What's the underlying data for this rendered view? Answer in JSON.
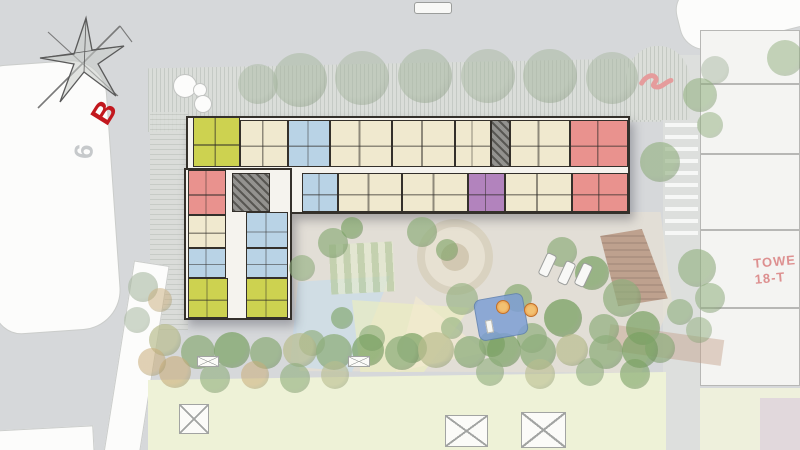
{
  "page": {
    "background": "#d6d8da"
  },
  "labels": {
    "block_marker": "B",
    "road_number": "9",
    "tower_line1": "TOWE",
    "tower_line2": "18-T"
  },
  "palette": {
    "wall": "#34302b",
    "cream": "#f0e9cf",
    "lime": "#cdd250",
    "blue": "#b9d3e6",
    "red": "#e9928e",
    "purple": "#b283bd",
    "core": "#93928f",
    "corridor": "#f5f3ee",
    "lawn": "#eef2d7",
    "pool": "#7e9fd4",
    "umbrella_orange": "#e8923e",
    "marker_red": "#c2181e",
    "tower_text": "#dd9090",
    "tree_faded": "#a9b9a2",
    "tree_mid": "#8fae7c",
    "tree_bright": "#79a162",
    "tree_olive": "#b9bd8e",
    "tree_orange": "#c9ad79"
  },
  "building": {
    "slabs": [
      {
        "x": 186,
        "y": 116,
        "w": 444,
        "h": 98
      },
      {
        "x": 184,
        "y": 168,
        "w": 108,
        "h": 152
      }
    ],
    "units": [
      {
        "x": 193,
        "y": 117,
        "w": 47,
        "h": 50,
        "c": "lime"
      },
      {
        "x": 240,
        "y": 120,
        "w": 48,
        "h": 47,
        "c": "cream"
      },
      {
        "x": 288,
        "y": 120,
        "w": 42,
        "h": 47,
        "c": "blue"
      },
      {
        "x": 330,
        "y": 120,
        "w": 62,
        "h": 47,
        "c": "cream"
      },
      {
        "x": 392,
        "y": 120,
        "w": 63,
        "h": 47,
        "c": "cream"
      },
      {
        "x": 455,
        "y": 120,
        "w": 36,
        "h": 47,
        "c": "cream"
      },
      {
        "x": 491,
        "y": 120,
        "w": 19,
        "h": 47,
        "c": "core"
      },
      {
        "x": 510,
        "y": 120,
        "w": 60,
        "h": 47,
        "c": "cream"
      },
      {
        "x": 570,
        "y": 120,
        "w": 58,
        "h": 47,
        "c": "red"
      },
      {
        "x": 232,
        "y": 173,
        "w": 38,
        "h": 39,
        "c": "core"
      },
      {
        "x": 302,
        "y": 173,
        "w": 36,
        "h": 39,
        "c": "blue"
      },
      {
        "x": 338,
        "y": 173,
        "w": 64,
        "h": 39,
        "c": "cream"
      },
      {
        "x": 402,
        "y": 173,
        "w": 66,
        "h": 39,
        "c": "cream"
      },
      {
        "x": 468,
        "y": 173,
        "w": 37,
        "h": 39,
        "c": "purple"
      },
      {
        "x": 505,
        "y": 173,
        "w": 67,
        "h": 39,
        "c": "cream"
      },
      {
        "x": 572,
        "y": 173,
        "w": 56,
        "h": 39,
        "c": "red"
      },
      {
        "x": 188,
        "y": 170,
        "w": 38,
        "h": 45,
        "c": "red"
      },
      {
        "x": 188,
        "y": 215,
        "w": 38,
        "h": 33,
        "c": "cream"
      },
      {
        "x": 188,
        "y": 248,
        "w": 38,
        "h": 30,
        "c": "blue"
      },
      {
        "x": 188,
        "y": 278,
        "w": 40,
        "h": 40,
        "c": "lime"
      },
      {
        "x": 246,
        "y": 212,
        "w": 42,
        "h": 36,
        "c": "blue"
      },
      {
        "x": 246,
        "y": 248,
        "w": 42,
        "h": 30,
        "c": "blue"
      },
      {
        "x": 246,
        "y": 278,
        "w": 42,
        "h": 40,
        "c": "lime"
      }
    ]
  },
  "neighbor_building": {
    "rooms": [
      {
        "x": 700,
        "y": 30,
        "w": 100,
        "h": 54
      },
      {
        "x": 700,
        "y": 84,
        "w": 100,
        "h": 70
      },
      {
        "x": 700,
        "y": 154,
        "w": 100,
        "h": 76
      },
      {
        "x": 700,
        "y": 230,
        "w": 100,
        "h": 78
      },
      {
        "x": 700,
        "y": 308,
        "w": 100,
        "h": 78
      }
    ]
  },
  "landscape": {
    "trees": [
      {
        "x": 258,
        "y": 84,
        "r": 20,
        "c": "tree_faded",
        "o": 0.5
      },
      {
        "x": 300,
        "y": 80,
        "r": 27,
        "c": "tree_faded",
        "o": 0.55
      },
      {
        "x": 362,
        "y": 78,
        "r": 27,
        "c": "tree_faded",
        "o": 0.5
      },
      {
        "x": 425,
        "y": 76,
        "r": 27,
        "c": "tree_faded",
        "o": 0.55
      },
      {
        "x": 488,
        "y": 76,
        "r": 27,
        "c": "tree_faded",
        "o": 0.5
      },
      {
        "x": 550,
        "y": 76,
        "r": 27,
        "c": "tree_faded",
        "o": 0.55
      },
      {
        "x": 612,
        "y": 78,
        "r": 26,
        "c": "tree_faded",
        "o": 0.5
      },
      {
        "x": 660,
        "y": 162,
        "r": 20,
        "c": "tree_mid",
        "o": 0.6
      },
      {
        "x": 785,
        "y": 58,
        "r": 18,
        "c": "tree_mid",
        "o": 0.5
      },
      {
        "x": 715,
        "y": 70,
        "r": 14,
        "c": "tree_faded",
        "o": 0.5
      },
      {
        "x": 700,
        "y": 95,
        "r": 17,
        "c": "tree_mid",
        "o": 0.55
      },
      {
        "x": 710,
        "y": 125,
        "r": 13,
        "c": "tree_mid",
        "o": 0.5
      },
      {
        "x": 697,
        "y": 268,
        "r": 19,
        "c": "tree_mid",
        "o": 0.6
      },
      {
        "x": 710,
        "y": 298,
        "r": 15,
        "c": "tree_mid",
        "o": 0.55
      },
      {
        "x": 699,
        "y": 330,
        "r": 13,
        "c": "tree_mid",
        "o": 0.5
      },
      {
        "x": 333,
        "y": 243,
        "r": 15,
        "c": "tree_mid",
        "o": 0.7
      },
      {
        "x": 352,
        "y": 228,
        "r": 11,
        "c": "tree_bright",
        "o": 0.65
      },
      {
        "x": 302,
        "y": 268,
        "r": 13,
        "c": "tree_mid",
        "o": 0.6
      },
      {
        "x": 422,
        "y": 232,
        "r": 15,
        "c": "tree_mid",
        "o": 0.7
      },
      {
        "x": 447,
        "y": 250,
        "r": 11,
        "c": "tree_bright",
        "o": 0.6
      },
      {
        "x": 562,
        "y": 252,
        "r": 15,
        "c": "tree_mid",
        "o": 0.7
      },
      {
        "x": 592,
        "y": 273,
        "r": 17,
        "c": "tree_bright",
        "o": 0.7
      },
      {
        "x": 622,
        "y": 298,
        "r": 19,
        "c": "tree_mid",
        "o": 0.7
      },
      {
        "x": 643,
        "y": 328,
        "r": 17,
        "c": "tree_bright",
        "o": 0.7
      },
      {
        "x": 604,
        "y": 329,
        "r": 15,
        "c": "tree_mid",
        "o": 0.7
      },
      {
        "x": 563,
        "y": 318,
        "r": 19,
        "c": "tree_bright",
        "o": 0.75
      },
      {
        "x": 532,
        "y": 338,
        "r": 15,
        "c": "tree_mid",
        "o": 0.7
      },
      {
        "x": 492,
        "y": 344,
        "r": 13,
        "c": "tree_bright",
        "o": 0.7
      },
      {
        "x": 452,
        "y": 328,
        "r": 11,
        "c": "tree_mid",
        "o": 0.6
      },
      {
        "x": 412,
        "y": 348,
        "r": 15,
        "c": "tree_bright",
        "o": 0.7
      },
      {
        "x": 372,
        "y": 338,
        "r": 13,
        "c": "tree_mid",
        "o": 0.65
      },
      {
        "x": 342,
        "y": 318,
        "r": 11,
        "c": "tree_bright",
        "o": 0.6
      },
      {
        "x": 312,
        "y": 343,
        "r": 13,
        "c": "tree_mid",
        "o": 0.65
      },
      {
        "x": 462,
        "y": 299,
        "r": 16,
        "c": "tree_mid",
        "o": 0.6
      },
      {
        "x": 518,
        "y": 298,
        "r": 14,
        "c": "tree_bright",
        "o": 0.6
      },
      {
        "x": 660,
        "y": 348,
        "r": 15,
        "c": "tree_mid",
        "o": 0.7
      },
      {
        "x": 680,
        "y": 312,
        "r": 13,
        "c": "tree_mid",
        "o": 0.6
      },
      {
        "x": 165,
        "y": 340,
        "r": 16,
        "c": "tree_olive",
        "o": 0.7
      },
      {
        "x": 198,
        "y": 352,
        "r": 17,
        "c": "tree_mid",
        "o": 0.75
      },
      {
        "x": 232,
        "y": 350,
        "r": 18,
        "c": "tree_bright",
        "o": 0.7
      },
      {
        "x": 266,
        "y": 353,
        "r": 16,
        "c": "tree_mid",
        "o": 0.75
      },
      {
        "x": 300,
        "y": 350,
        "r": 17,
        "c": "tree_olive",
        "o": 0.7
      },
      {
        "x": 334,
        "y": 352,
        "r": 18,
        "c": "tree_mid",
        "o": 0.75
      },
      {
        "x": 368,
        "y": 350,
        "r": 16,
        "c": "tree_bright",
        "o": 0.7
      },
      {
        "x": 402,
        "y": 353,
        "r": 17,
        "c": "tree_mid",
        "o": 0.75
      },
      {
        "x": 436,
        "y": 350,
        "r": 18,
        "c": "tree_olive",
        "o": 0.7
      },
      {
        "x": 470,
        "y": 352,
        "r": 16,
        "c": "tree_mid",
        "o": 0.75
      },
      {
        "x": 504,
        "y": 350,
        "r": 17,
        "c": "tree_bright",
        "o": 0.7
      },
      {
        "x": 538,
        "y": 352,
        "r": 18,
        "c": "tree_mid",
        "o": 0.75
      },
      {
        "x": 572,
        "y": 350,
        "r": 16,
        "c": "tree_olive",
        "o": 0.7
      },
      {
        "x": 606,
        "y": 352,
        "r": 17,
        "c": "tree_mid",
        "o": 0.75
      },
      {
        "x": 640,
        "y": 350,
        "r": 18,
        "c": "tree_bright",
        "o": 0.7
      },
      {
        "x": 175,
        "y": 372,
        "r": 16,
        "c": "tree_orange",
        "o": 0.6
      },
      {
        "x": 215,
        "y": 378,
        "r": 15,
        "c": "tree_mid",
        "o": 0.6
      },
      {
        "x": 255,
        "y": 375,
        "r": 14,
        "c": "tree_orange",
        "o": 0.55
      },
      {
        "x": 295,
        "y": 378,
        "r": 15,
        "c": "tree_mid",
        "o": 0.6
      },
      {
        "x": 335,
        "y": 375,
        "r": 14,
        "c": "tree_olive",
        "o": 0.6
      },
      {
        "x": 490,
        "y": 372,
        "r": 14,
        "c": "tree_mid",
        "o": 0.6
      },
      {
        "x": 540,
        "y": 374,
        "r": 15,
        "c": "tree_olive",
        "o": 0.6
      },
      {
        "x": 590,
        "y": 372,
        "r": 14,
        "c": "tree_mid",
        "o": 0.6
      },
      {
        "x": 635,
        "y": 374,
        "r": 15,
        "c": "tree_bright",
        "o": 0.6
      },
      {
        "x": 143,
        "y": 287,
        "r": 15,
        "c": "tree_faded",
        "o": 0.6
      },
      {
        "x": 137,
        "y": 320,
        "r": 13,
        "c": "tree_faded",
        "o": 0.55
      },
      {
        "x": 160,
        "y": 300,
        "r": 12,
        "c": "tree_orange",
        "o": 0.5
      },
      {
        "x": 152,
        "y": 362,
        "r": 14,
        "c": "tree_orange",
        "o": 0.55
      }
    ],
    "white_circles": [
      {
        "x": 185,
        "y": 86,
        "r": 12
      },
      {
        "x": 200,
        "y": 90,
        "r": 7
      },
      {
        "x": 203,
        "y": 104,
        "r": 9
      }
    ],
    "planters": [
      {
        "x": 179,
        "y": 404,
        "w": 30,
        "h": 30
      },
      {
        "x": 445,
        "y": 415,
        "w": 43,
        "h": 32
      },
      {
        "x": 521,
        "y": 412,
        "w": 45,
        "h": 36
      },
      {
        "x": 197,
        "y": 356,
        "w": 22,
        "h": 11
      },
      {
        "x": 348,
        "y": 356,
        "w": 22,
        "h": 11
      }
    ],
    "cars": [
      {
        "x": 542,
        "y": 253,
        "w": 11,
        "h": 24,
        "rot": 25
      },
      {
        "x": 561,
        "y": 261,
        "w": 11,
        "h": 24,
        "rot": 25
      },
      {
        "x": 578,
        "y": 263,
        "w": 11,
        "h": 24,
        "rot": 25
      },
      {
        "x": 414,
        "y": 2,
        "w": 38,
        "h": 12,
        "rot": 0
      }
    ],
    "pool": {
      "x": 476,
      "y": 296,
      "w": 50,
      "h": 42,
      "rot": -10
    },
    "umbrellas": [
      {
        "x": 496,
        "y": 300,
        "r": 7
      },
      {
        "x": 524,
        "y": 303,
        "r": 7
      }
    ]
  }
}
